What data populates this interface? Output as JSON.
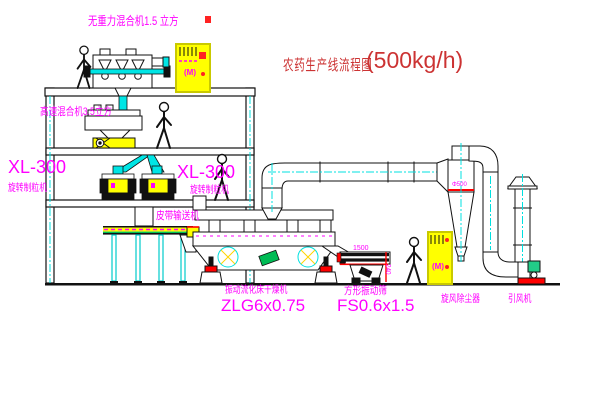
{
  "diagram": {
    "title": {
      "cn": "农药生产线流程图",
      "capacity": "(500kg/h)"
    },
    "equipment_labels": {
      "gravity_mixer": "无重力混合机1.5 立方",
      "high_speed_mixer": "高速混合机3.5立方",
      "granulator_model": "XL-300",
      "granulator_name": "旋转制粒机",
      "belt_conveyor": "皮带输送机",
      "dryer_name": "振动流化床干燥机",
      "dryer_model": "ZLG6x0.75",
      "screen_name": "方形振动筛",
      "screen_model": "FS0.6x1.5",
      "cyclone": "旋风除尘器",
      "fan": "引风机"
    },
    "dimensions": {
      "screen_width": "1500",
      "screen_side": "240",
      "cyclone_dia": "Φ500"
    },
    "cabinet_motor_symbol": "(M)",
    "colors": {
      "label_magenta": "#ff00ff",
      "title_red": "#cc3333",
      "centerline_cyan": "#00e0e0",
      "cabinet_yellow": "#ffff00",
      "accent_red": "#ff0000",
      "accent_green": "#00bb55"
    }
  }
}
